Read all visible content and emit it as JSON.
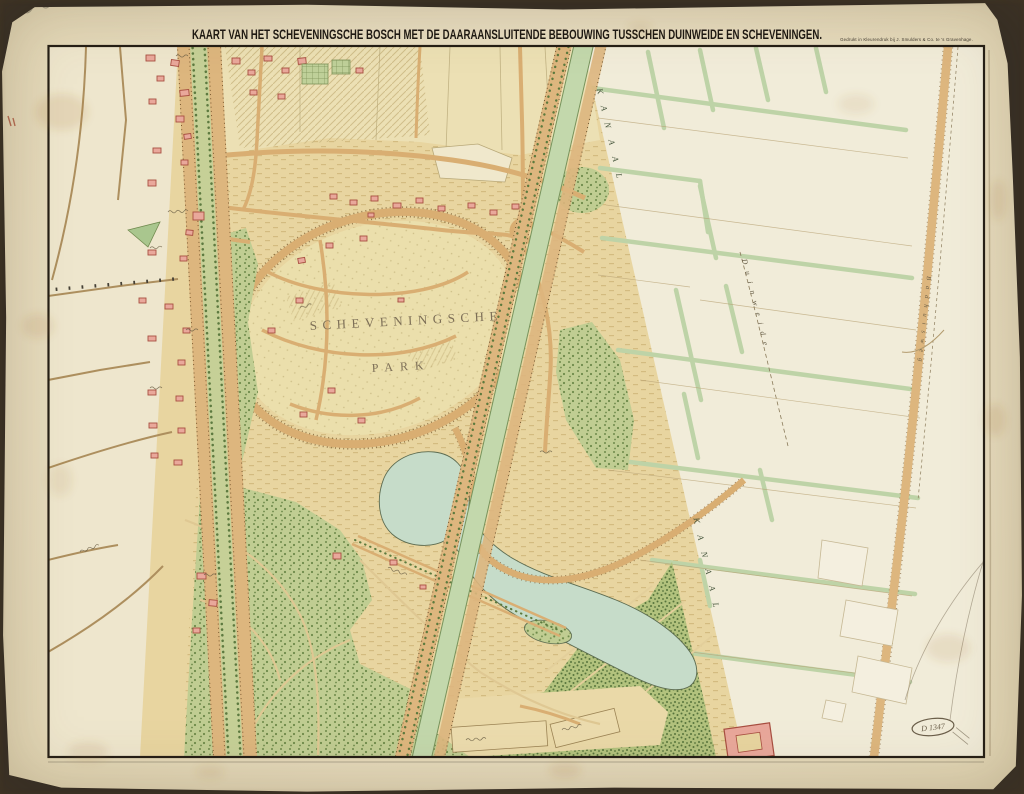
{
  "title": "KAART VAN HET SCHEVENINGSCHE BOSCH MET DE DAARAANSLUITENDE BEBOUWING TUSSCHEN DUINWEIDE EN SCHEVENINGEN.",
  "imprint": "Gedrukt in Kleurendruk bij J. Smulders & Co. te 's Gravenhage.",
  "labels": {
    "park_name_line1": "SCHEVENINGSCHE",
    "park_name_line2": "PARK",
    "canal_upper": "KANAAL",
    "canal_lower": "KANAAL",
    "polder_area": "Duinweide",
    "right_road": "Badhuisweg"
  },
  "annotations": {
    "inventory_mark": "D 1347"
  },
  "palette": {
    "paper": "#e8ddc0",
    "dune": "#e8d5a0",
    "forest": "#c0cd92",
    "water": "#c6dcc9",
    "road": "#d9ae72",
    "building": "#e9a89b",
    "polder": "#f1ecd9",
    "ink": "#241e15"
  }
}
